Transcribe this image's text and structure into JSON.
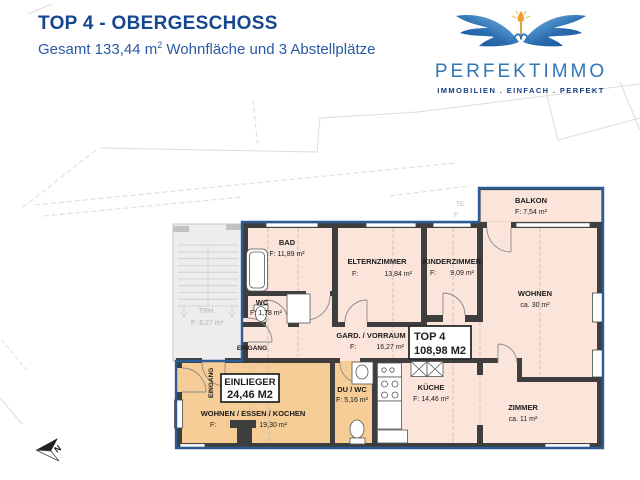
{
  "header": {
    "title": "TOP 4 - OBERGESCHOSS",
    "subtitle": {
      "part1": "Gesamt 133,44 m",
      "sup": "2",
      "part2": " Wohnfläche und 3 Abstellplätze"
    }
  },
  "logo": {
    "brand": "PERFEKTIMMO",
    "tagline": "IMMOBILIEN . EINFACH . PERFEKT",
    "icon": "wings-crest-icon"
  },
  "plan": {
    "rooms": {
      "bad": {
        "name": "BAD",
        "area": "F: 11,89 m²"
      },
      "wc": {
        "name": "WC",
        "area": "F: 1,78 m²"
      },
      "elternzimmer": {
        "name": "ELTERNZIMMER",
        "area_label": "F:",
        "area_value": "13,84 m²"
      },
      "kinderzimmer": {
        "name": "KINDERZIMMER",
        "area_label": "F:",
        "area_value": "9,09 m²"
      },
      "balkon": {
        "name": "BALKON",
        "area": "F: 7,54 m²"
      },
      "wohnen": {
        "name": "WOHNEN",
        "area": "ca. 30 m²"
      },
      "gard_vorraum": {
        "name": "GARD. / VORRAUM",
        "area_label": "F:",
        "area_value": "16,27 m²"
      },
      "kueche": {
        "name": "KÜCHE",
        "area": "F: 14,46 m²"
      },
      "zimmer": {
        "name": "ZIMMER",
        "area": "ca. 11 m²"
      },
      "du_wc": {
        "name": "DU / WC",
        "area": "F: 5,16 m²"
      },
      "wohnen_essen_kochen": {
        "name": "WOHNEN / ESSEN / KOCHEN",
        "area_label": "F:",
        "area_value": "19,30 m²"
      },
      "treppenhaus": {
        "name": "TRH.",
        "area": "F: 6,27 m²"
      }
    },
    "badges": {
      "top4": {
        "line1": "TOP 4",
        "line2": "108,98 M2"
      },
      "einlieger": {
        "line1": "EINLIEGER",
        "line2": "24,46 M2"
      }
    },
    "labels": {
      "eingang_main": "EINGANG",
      "eingang_side": "EINGANG",
      "north": "N",
      "bg_te": "TE",
      "bg_f": "F:"
    },
    "colors": {
      "title_navy": "#17478f",
      "outline_blue": "#2b5c97",
      "room_pink": "#fbe4da",
      "einlieger_orange": "#f6cd96",
      "wall_dark": "#3e3e3e",
      "logo_blue": "#3176b6",
      "logo_gold": "#f1a02c"
    }
  }
}
